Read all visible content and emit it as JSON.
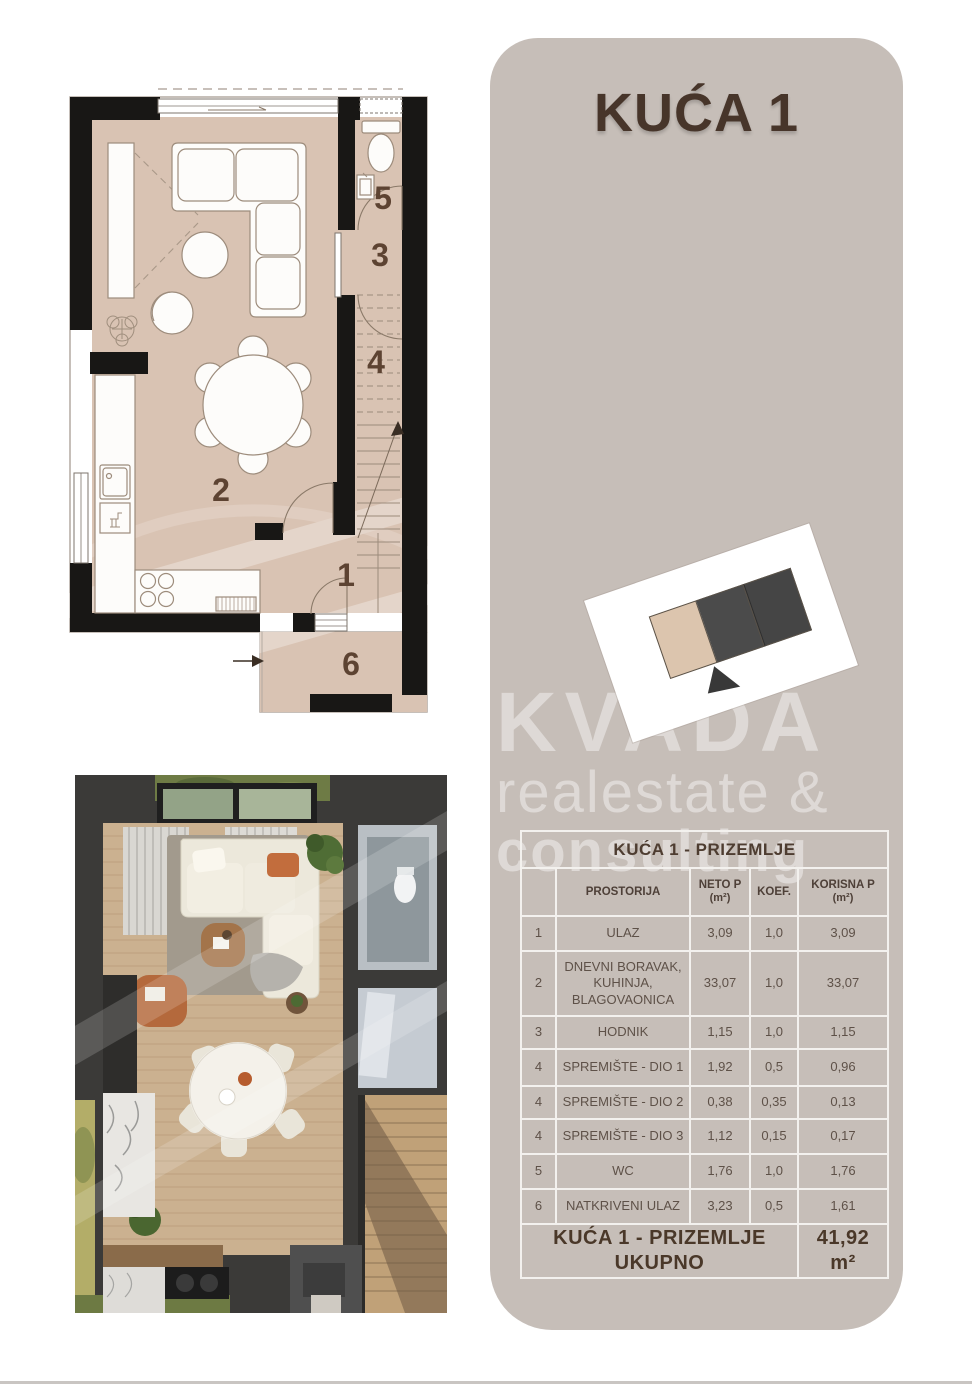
{
  "panel": {
    "title": "KUĆA 1",
    "bg_color": "#c6beb8",
    "accent_color": "#47352a"
  },
  "watermark": {
    "line1": "KVADA",
    "line2": "realestate &",
    "line3": "consulting"
  },
  "site_plan": {
    "card_color": "#ffffff",
    "unit_colors": [
      "#dcc5ae",
      "#4b4b4b",
      "#454545"
    ],
    "arrow_color": "#383838",
    "highlighted_unit_index": 0
  },
  "plan": {
    "floor_color": "#d9c3b3",
    "wall_color": "#181715",
    "number_color": "#5d4332",
    "rooms": [
      {
        "num": "1"
      },
      {
        "num": "2"
      },
      {
        "num": "3"
      },
      {
        "num": "4"
      },
      {
        "num": "5"
      },
      {
        "num": "6"
      }
    ]
  },
  "table": {
    "band": "KUĆA 1 - PRIZEMLJE",
    "columns": [
      {
        "label": "",
        "unit": ""
      },
      {
        "label": "PROSTORIJA",
        "unit": ""
      },
      {
        "label": "NETO P",
        "unit": "(m²)"
      },
      {
        "label": "KOEF.",
        "unit": ""
      },
      {
        "label": "KORISNA P",
        "unit": "(m²)"
      }
    ],
    "rows": [
      {
        "num": "1",
        "name": "ULAZ",
        "neto": "3,09",
        "koef": "1,0",
        "korisna": "3,09"
      },
      {
        "num": "2",
        "name": "DNEVNI BORAVAK, KUHINJA, BLAGOVAONICA",
        "neto": "33,07",
        "koef": "1,0",
        "korisna": "33,07"
      },
      {
        "num": "3",
        "name": "HODNIK",
        "neto": "1,15",
        "koef": "1,0",
        "korisna": "1,15"
      },
      {
        "num": "4",
        "name": "SPREMIŠTE - DIO 1",
        "neto": "1,92",
        "koef": "0,5",
        "korisna": "0,96"
      },
      {
        "num": "4",
        "name": "SPREMIŠTE - DIO 2",
        "neto": "0,38",
        "koef": "0,35",
        "korisna": "0,13"
      },
      {
        "num": "4",
        "name": "SPREMIŠTE - DIO 3",
        "neto": "1,12",
        "koef": "0,15",
        "korisna": "0,17"
      },
      {
        "num": "5",
        "name": "WC",
        "neto": "1,76",
        "koef": "1,0",
        "korisna": "1,76"
      },
      {
        "num": "6",
        "name": "NATKRIVENI ULAZ",
        "neto": "3,23",
        "koef": "0,5",
        "korisna": "1,61"
      }
    ],
    "total_label": "KUĆA 1 - PRIZEMLJE UKUPNO",
    "total_value": "41,92 m²"
  }
}
